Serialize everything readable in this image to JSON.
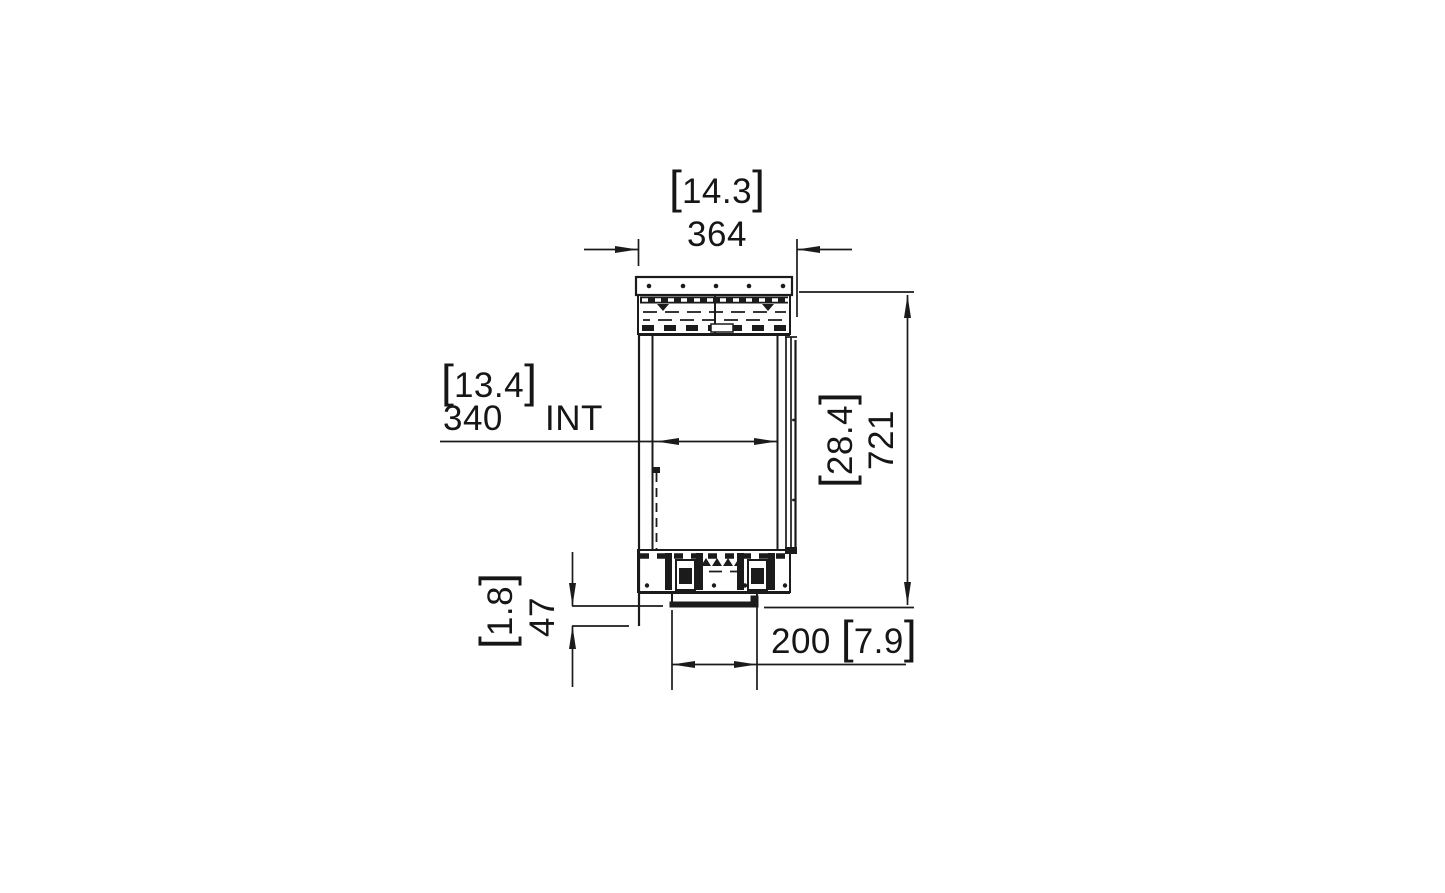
{
  "drawing": {
    "type": "fireplace-firebox-side-section",
    "units": {
      "primary": "mm",
      "secondary": "in"
    },
    "colors": {
      "line": "#1b1b1b",
      "background": "#ffffff"
    },
    "symbols": {
      "bracket_open": "[",
      "bracket_close": "]"
    },
    "dimensions": {
      "overall_width": {
        "mm": "364",
        "in": "14.3"
      },
      "internal_width": {
        "mm": "340",
        "in": "13.4",
        "label": "INT"
      },
      "overall_height": {
        "mm": "721",
        "in": "28.4"
      },
      "base_drop": {
        "mm": "47",
        "in": "1.8"
      },
      "spigot_width": {
        "mm": "200",
        "in": "7.9"
      }
    }
  }
}
